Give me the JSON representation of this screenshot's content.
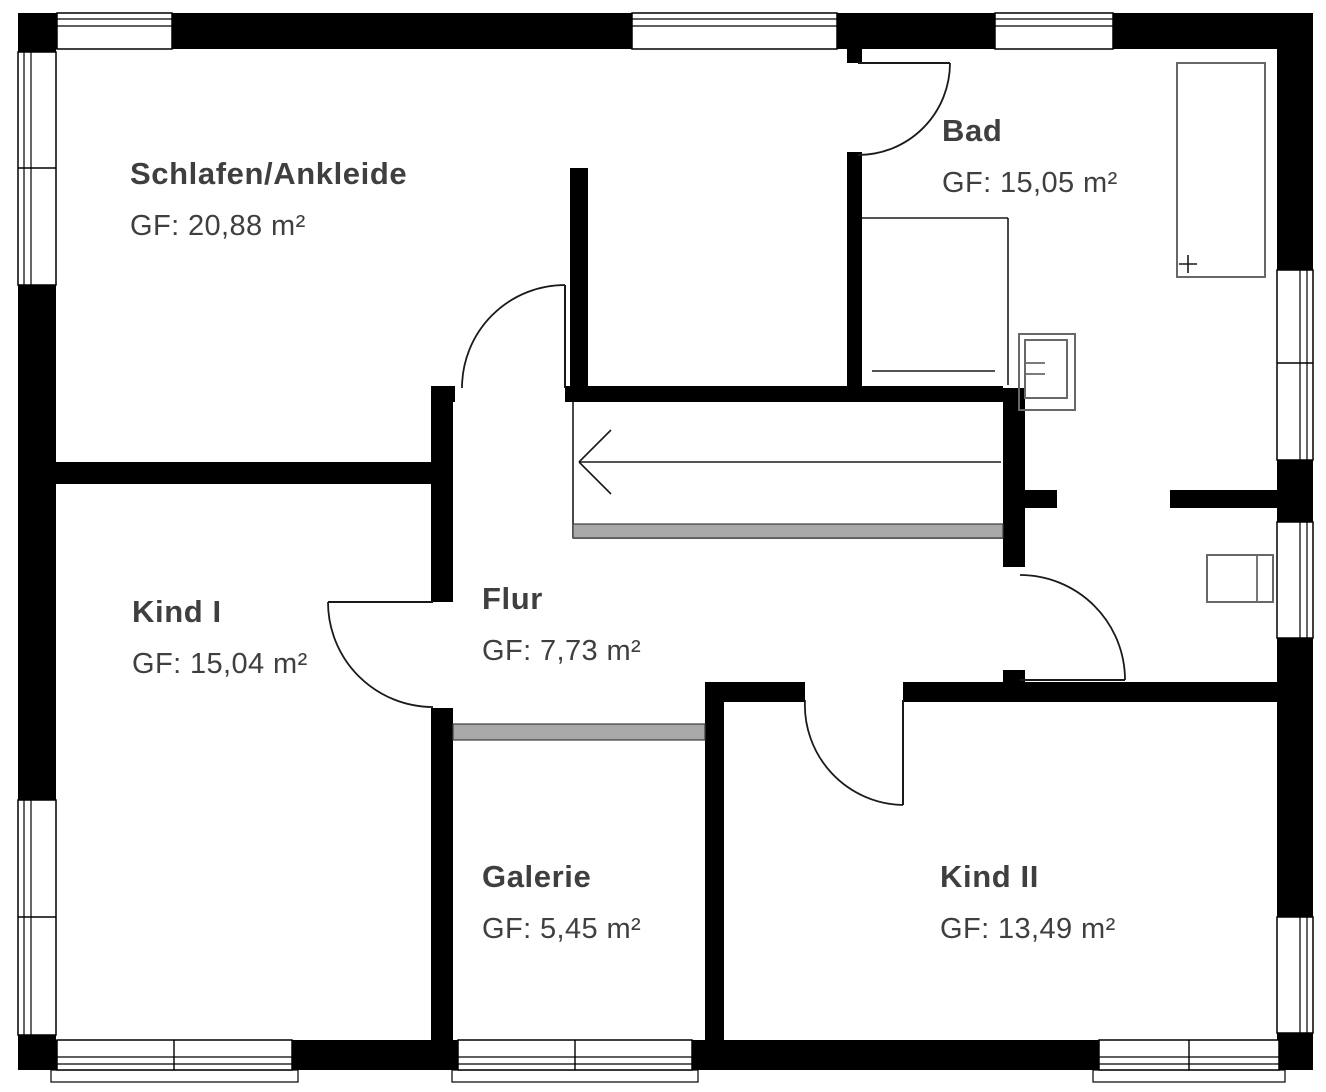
{
  "colors": {
    "wall": "#000000",
    "thin_line": "#1a1a1a",
    "fixture": "#686868",
    "railing_fill": "#a8a8a8",
    "railing_stroke": "#3d3d3d",
    "text": "#3f3f3f",
    "background": "#ffffff"
  },
  "rooms": [
    {
      "name": "Schlafen/Ankleide",
      "area": "GF: 20,88 m²",
      "x": 130,
      "y": 156
    },
    {
      "name": "Bad",
      "area": "GF: 15,05 m²",
      "x": 942,
      "y": 113
    },
    {
      "name": "Kind I",
      "area": "GF: 15,04 m²",
      "x": 132,
      "y": 594
    },
    {
      "name": "Flur",
      "area": "GF: 7,73 m²",
      "x": 482,
      "y": 581
    },
    {
      "name": "Galerie",
      "area": "GF: 5,45 m²",
      "x": 482,
      "y": 859
    },
    {
      "name": "Kind II",
      "area": "GF: 13,49 m²",
      "x": 940,
      "y": 859
    }
  ],
  "plan": {
    "width": 1326,
    "height": 1092,
    "walls": [
      [
        18,
        13,
        1295,
        36
      ],
      [
        18,
        13,
        38,
        1057
      ],
      [
        1277,
        13,
        36,
        1057
      ],
      [
        18,
        1040,
        1295,
        30
      ],
      [
        570,
        168,
        18,
        220
      ],
      [
        431,
        386,
        24,
        16
      ],
      [
        565,
        386,
        438,
        16
      ],
      [
        847,
        49,
        15,
        14
      ],
      [
        847,
        152,
        15,
        236
      ],
      [
        1003,
        388,
        22,
        179
      ],
      [
        1003,
        670,
        22,
        12
      ],
      [
        1025,
        490,
        32,
        18
      ],
      [
        1170,
        490,
        107,
        18
      ],
      [
        705,
        682,
        100,
        20
      ],
      [
        903,
        682,
        374,
        20
      ],
      [
        431,
        402,
        22,
        200
      ],
      [
        431,
        708,
        22,
        332
      ],
      [
        56,
        462,
        375,
        22
      ],
      [
        705,
        682,
        19,
        358
      ]
    ],
    "windows": [
      {
        "rect": [
          57,
          13,
          115,
          36
        ],
        "side": "top",
        "divider": null,
        "sill": false
      },
      {
        "rect": [
          632,
          13,
          205,
          36
        ],
        "side": "top",
        "divider": null,
        "sill": false
      },
      {
        "rect": [
          995,
          13,
          118,
          36
        ],
        "side": "top",
        "divider": null,
        "sill": false
      },
      {
        "rect": [
          18,
          52,
          38,
          233
        ],
        "side": "left",
        "divider": 168,
        "sill": false
      },
      {
        "rect": [
          18,
          800,
          38,
          235
        ],
        "side": "left",
        "divider": 917,
        "sill": false
      },
      {
        "rect": [
          1277,
          270,
          36,
          190
        ],
        "side": "right",
        "divider": 363,
        "sill": false
      },
      {
        "rect": [
          1277,
          522,
          36,
          116
        ],
        "side": "right",
        "divider": null,
        "sill": false
      },
      {
        "rect": [
          1277,
          917,
          36,
          116
        ],
        "side": "right",
        "divider": null,
        "sill": false
      },
      {
        "rect": [
          57,
          1040,
          235,
          30
        ],
        "side": "bottom",
        "divider": 174,
        "sill": true
      },
      {
        "rect": [
          458,
          1040,
          234,
          30
        ],
        "side": "bottom",
        "divider": 575,
        "sill": true
      },
      {
        "rect": [
          1099,
          1040,
          180,
          30
        ],
        "side": "bottom",
        "divider": 1189,
        "sill": true
      }
    ],
    "doors": [
      {
        "leaf": [
          565,
          388,
          565,
          285
        ],
        "arc": {
          "from": [
            565,
            285
          ],
          "to": [
            462,
            388
          ],
          "r": 103,
          "sweep": 0
        }
      },
      {
        "leaf": [
          858,
          63,
          950,
          63
        ],
        "arc": {
          "from": [
            950,
            63
          ],
          "to": [
            858,
            155
          ],
          "r": 92,
          "sweep": 1
        }
      },
      {
        "leaf": [
          1020,
          680,
          1125,
          680
        ],
        "arc": {
          "from": [
            1125,
            680
          ],
          "to": [
            1020,
            575
          ],
          "r": 105,
          "sweep": 0
        }
      },
      {
        "leaf": [
          433,
          602,
          328,
          602
        ],
        "arc": {
          "from": [
            328,
            602
          ],
          "to": [
            433,
            707
          ],
          "r": 105,
          "sweep": 0
        }
      },
      {
        "leaf": [
          903,
          700,
          903,
          805
        ],
        "arc": {
          "from": [
            805,
            700
          ],
          "to": [
            903,
            805
          ],
          "r": 100,
          "sweep": 0
        }
      }
    ],
    "stairs": {
      "outline": [
        [
          573,
          402,
          573,
          538
        ],
        [
          573,
          538,
          1003,
          538
        ]
      ],
      "strip": [
        573,
        524,
        430,
        14
      ],
      "arrow_shaft": [
        1001,
        462,
        579,
        462
      ],
      "arrow_head": [
        [
          579,
          462,
          611,
          430
        ],
        [
          579,
          462,
          611,
          494
        ]
      ]
    },
    "railing": [
      453,
      724,
      252,
      16
    ],
    "fixtures": {
      "rects": [
        {
          "name": "bathtub",
          "r": [
            1177,
            63,
            88,
            214
          ]
        },
        {
          "name": "washbasin-outer",
          "r": [
            1019,
            334,
            56,
            76
          ]
        },
        {
          "name": "washbasin-inner",
          "r": [
            1025,
            340,
            42,
            58
          ]
        },
        {
          "name": "radiator",
          "r": [
            1207,
            555,
            66,
            47
          ]
        }
      ],
      "lines_dark": [
        [
          862,
          218,
          1008,
          218
        ],
        [
          1008,
          218,
          1008,
          385
        ],
        [
          872,
          371,
          995,
          371
        ],
        [
          1179,
          264,
          1197,
          264
        ],
        [
          1188,
          255,
          1188,
          273
        ]
      ],
      "lines_gray": [
        [
          1025,
          363,
          1045,
          363
        ],
        [
          1025,
          374,
          1045,
          374
        ],
        [
          1257,
          555,
          1257,
          602
        ]
      ]
    }
  }
}
